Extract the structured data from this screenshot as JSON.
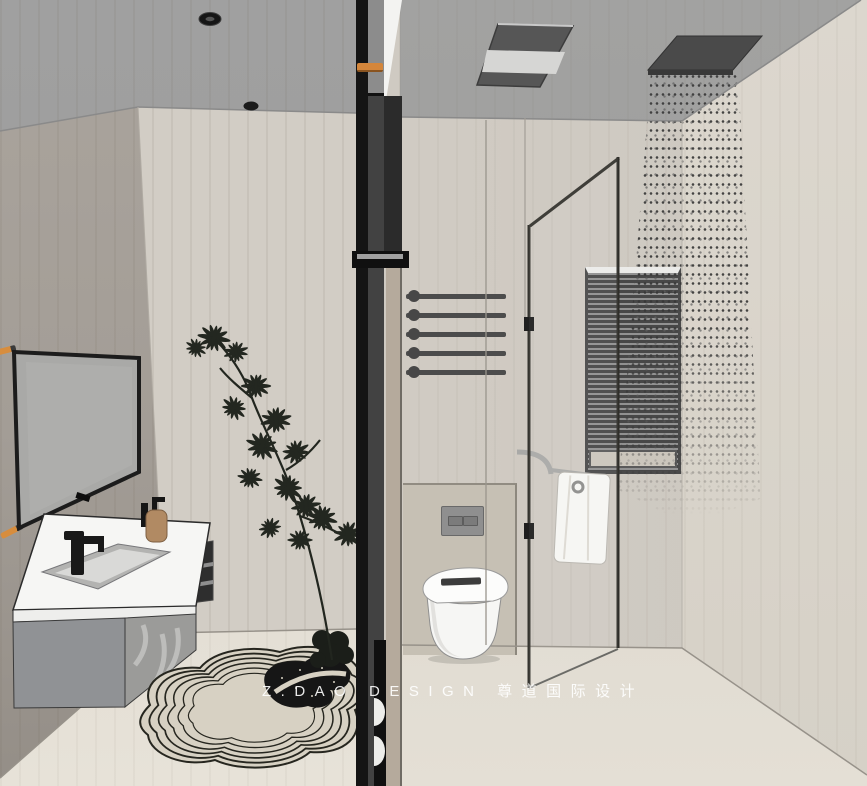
{
  "watermark": {
    "text": "Z.DAO DESIGN 尊道国际设计"
  },
  "palette": {
    "ceiling": "#9e9e9e",
    "wall_left": "#a8a29b",
    "wall_back": "#d2cdc5",
    "wall_right": "#dad5cc",
    "floor": "#e3ded4",
    "divider_dark": "#141414",
    "divider_wood": "#b5aa9c",
    "accent_orange": "#d4863b",
    "fixture_white": "#f6f6f4",
    "cabinet_gray": "#909295",
    "foliage_dark": "#232720",
    "glass_frame": "#35342f"
  },
  "scene": {
    "type": "3d-interior-render",
    "room": "bathroom",
    "objects": [
      "recessed-downlights",
      "wall-mirror",
      "floating-vanity",
      "black-faucet",
      "soap-bottle",
      "potted-plant",
      "contour-rug",
      "center-divider",
      "towel-bars",
      "wall-hung-toilet",
      "flush-plate",
      "window-blinds",
      "glass-shower-partition",
      "towel-on-ring",
      "ceiling-heater-unit",
      "rain-shower-head",
      "water-spray"
    ]
  }
}
